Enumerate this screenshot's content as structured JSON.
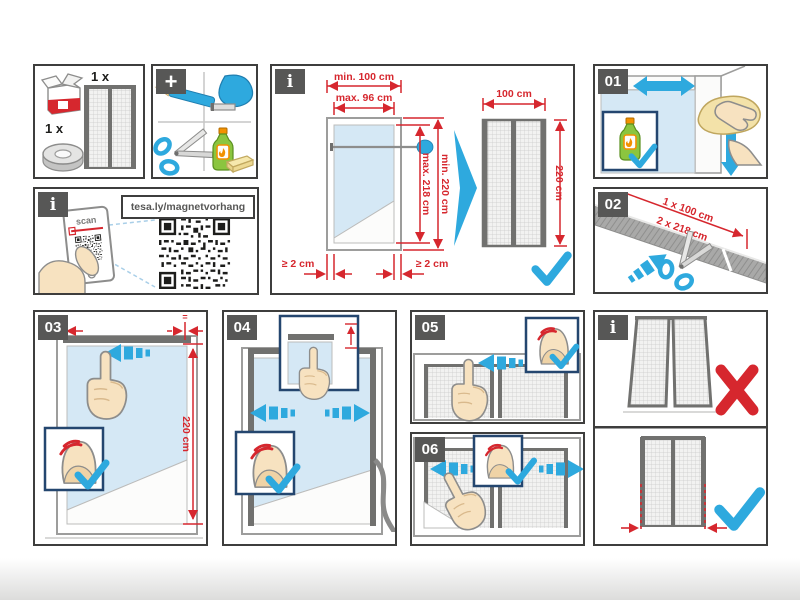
{
  "colors": {
    "accent_red": "#d6272e",
    "accent_blue": "#2ea9de",
    "badge_gray": "#575756",
    "border": "#3e3e3d",
    "glass_blue": "#d5e8f5",
    "tape_dark": "#71716f"
  },
  "kit": {
    "curtain_qty": "1 x",
    "tape_qty": "1 x",
    "plus": "+"
  },
  "qr": {
    "info": "i",
    "scan_label": "scan",
    "url": "tesa.ly/magnetvorhang"
  },
  "sizing": {
    "info": "i",
    "door_min_width": "min. 100 cm",
    "door_max_width": "max. 96 cm",
    "door_max_height": "max. 218 cm",
    "door_min_height": "min. 220 cm",
    "margin_left": "≥ 2 cm",
    "margin_right": "≥ 2 cm",
    "curtain_width": "100 cm",
    "curtain_height": "220 cm"
  },
  "steps": {
    "s01": {
      "num": "01"
    },
    "s02": {
      "num": "02",
      "cut_a": "1 x 100 cm",
      "cut_b": "2 x 218 cm"
    },
    "s03": {
      "num": "03",
      "height": "220 cm",
      "equal_left": "=",
      "equal_right": "="
    },
    "s04": {
      "num": "04"
    },
    "s05": {
      "num": "05"
    },
    "s06": {
      "num": "06"
    }
  },
  "hanging": {
    "info": "i"
  }
}
